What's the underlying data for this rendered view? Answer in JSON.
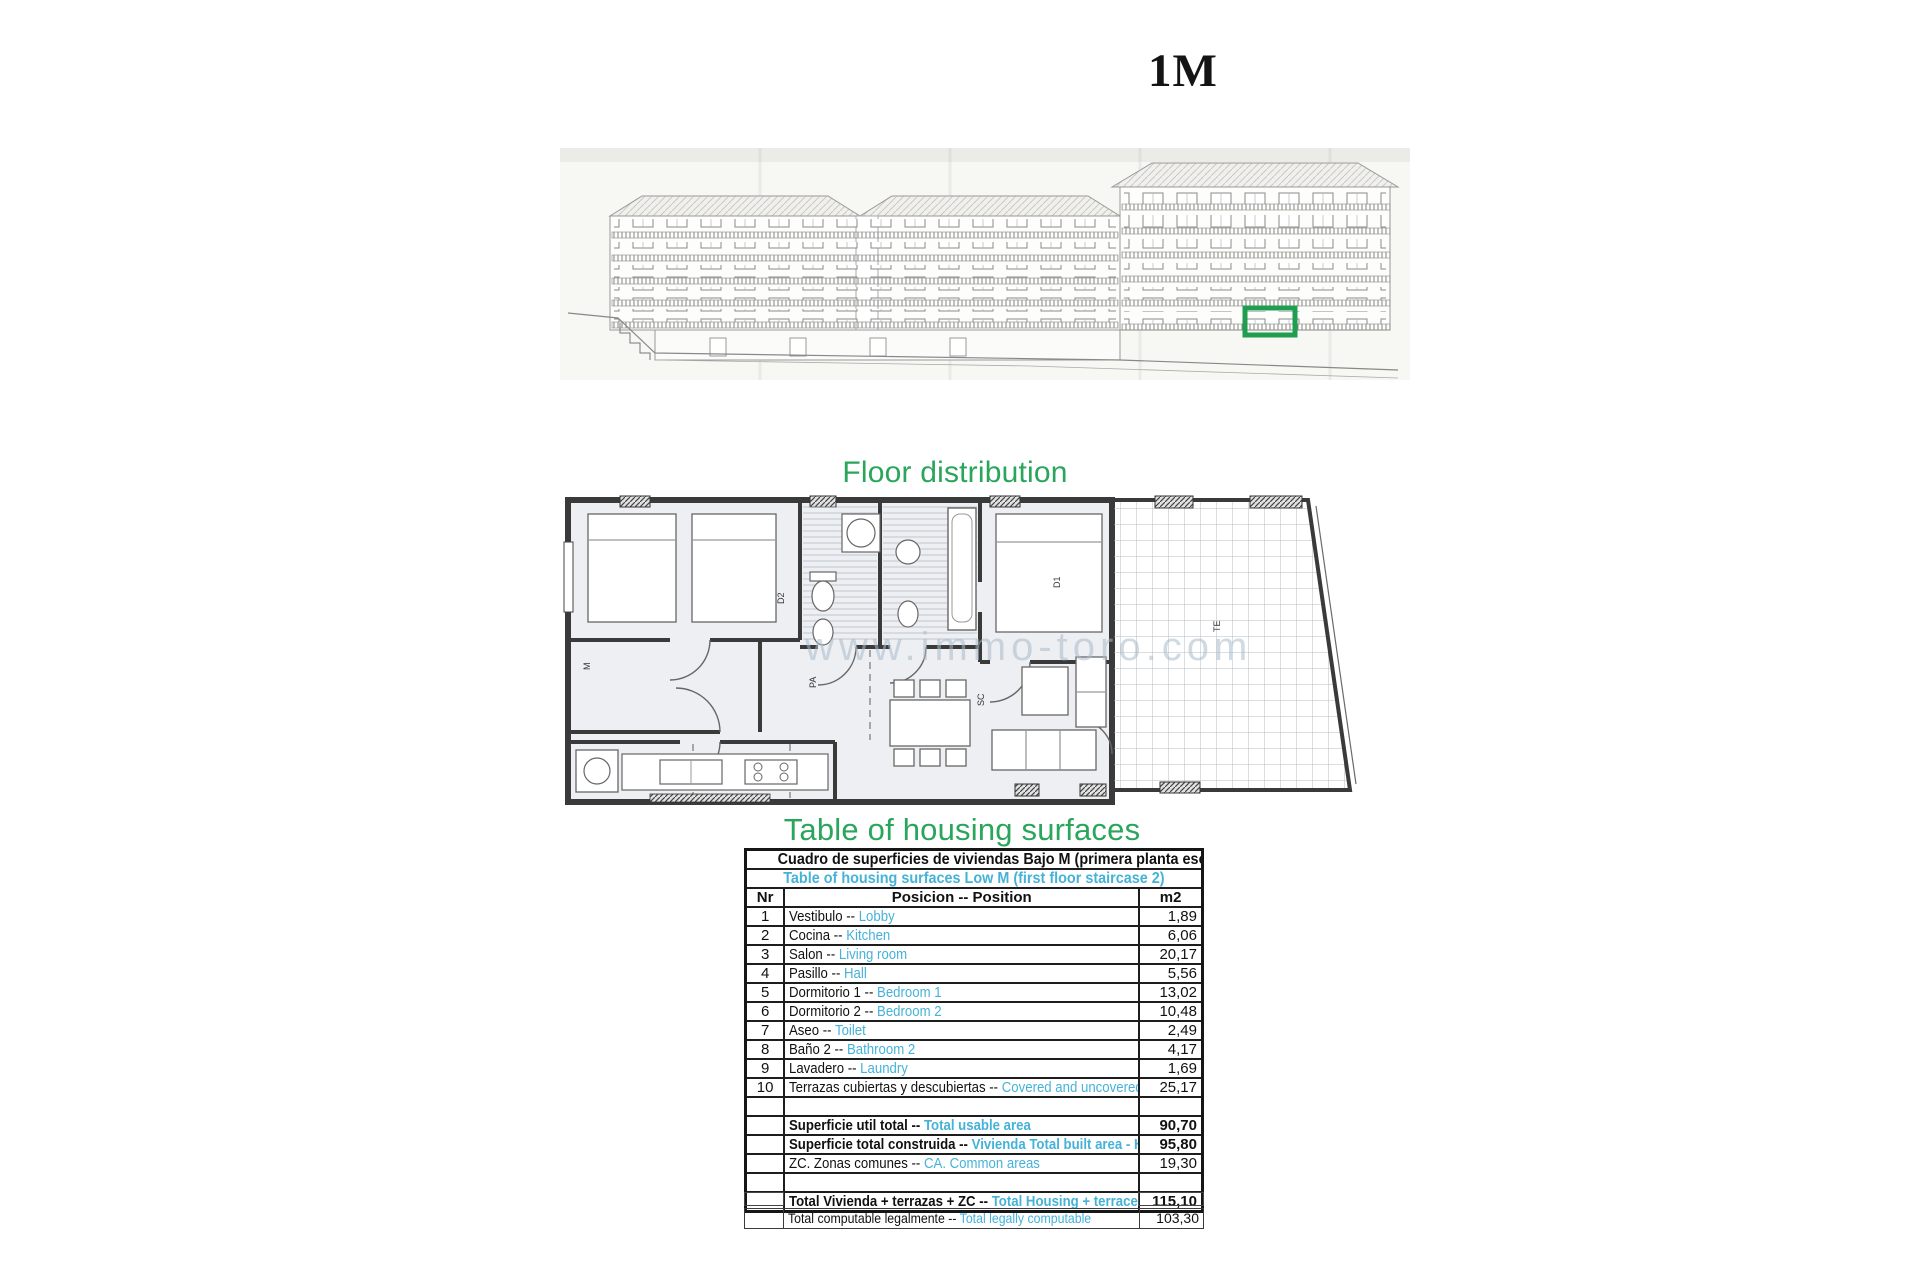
{
  "page": {
    "unit_title": "1M"
  },
  "headings": {
    "floor_distribution": "Floor distribution",
    "table_of_surfaces": "Table of housing surfaces"
  },
  "colors": {
    "green_heading": "#2aa55c",
    "cyan_text": "#45b2d8",
    "highlight_box_green": "#1f9e50"
  },
  "plan": {
    "watermark": "www.immo-toro.com",
    "labels": {
      "m": "M",
      "d2": "D2",
      "d1": "D1",
      "pa": "PA",
      "sc": "SC",
      "te": "TE"
    }
  },
  "table": {
    "title_es": "Cuadro de superficies de viviendas Bajo M (primera planta escalera 2)",
    "title_en": "Table of housing surfaces Low M  (first floor staircase 2)",
    "col_nr": "Nr",
    "col_pos": "Posicion -- Position",
    "col_m2": "m2",
    "rows": [
      {
        "nr": "1",
        "es": "Vestibulo --",
        "en": "Lobby",
        "m2": "1,89"
      },
      {
        "nr": "2",
        "es": "Cocina --",
        "en": "Kitchen",
        "m2": "6,06"
      },
      {
        "nr": "3",
        "es": "Salon --",
        "en": "Living room",
        "m2": "20,17"
      },
      {
        "nr": "4",
        "es": "Pasillo --",
        "en": "Hall",
        "m2": "5,56"
      },
      {
        "nr": "5",
        "es": "Dormitorio 1 --",
        "en": "Bedroom 1",
        "m2": "13,02"
      },
      {
        "nr": "6",
        "es": "Dormitorio 2 --",
        "en": "Bedroom 2",
        "m2": "10,48"
      },
      {
        "nr": "7",
        "es": "Aseo --",
        "en": "Toilet",
        "m2": "2,49"
      },
      {
        "nr": "8",
        "es": "Baño 2 --",
        "en": "Bathroom 2",
        "m2": "4,17"
      },
      {
        "nr": "9",
        "es": "Lavadero --",
        "en": "Laundry",
        "m2": "1,69"
      },
      {
        "nr": "10",
        "es": "Terrazas cubiertas y descubiertas --",
        "en": "Covered and uncovered terraces",
        "m2": "25,17"
      },
      {
        "empty": true
      },
      {
        "es": "Superficie util total --",
        "en": "Total usable area",
        "m2": "90,70",
        "bold": true
      },
      {
        "es": "Superficie total construida --",
        "en": "Vivienda Total built area - Housing",
        "m2": "95,80",
        "bold": true
      },
      {
        "es": "ZC. Zonas comunes  --",
        "en": "CA. Common areas",
        "m2": "19,30"
      },
      {
        "empty": true
      },
      {
        "es": "Total Vivienda + terrazas + ZC  --",
        "en": "Total Housing + terraces + CA",
        "m2": "115,10",
        "bold": true
      }
    ],
    "footer": {
      "es": "Total computable legalmente --",
      "en": "Total legally computable",
      "m2": "103,30"
    }
  }
}
